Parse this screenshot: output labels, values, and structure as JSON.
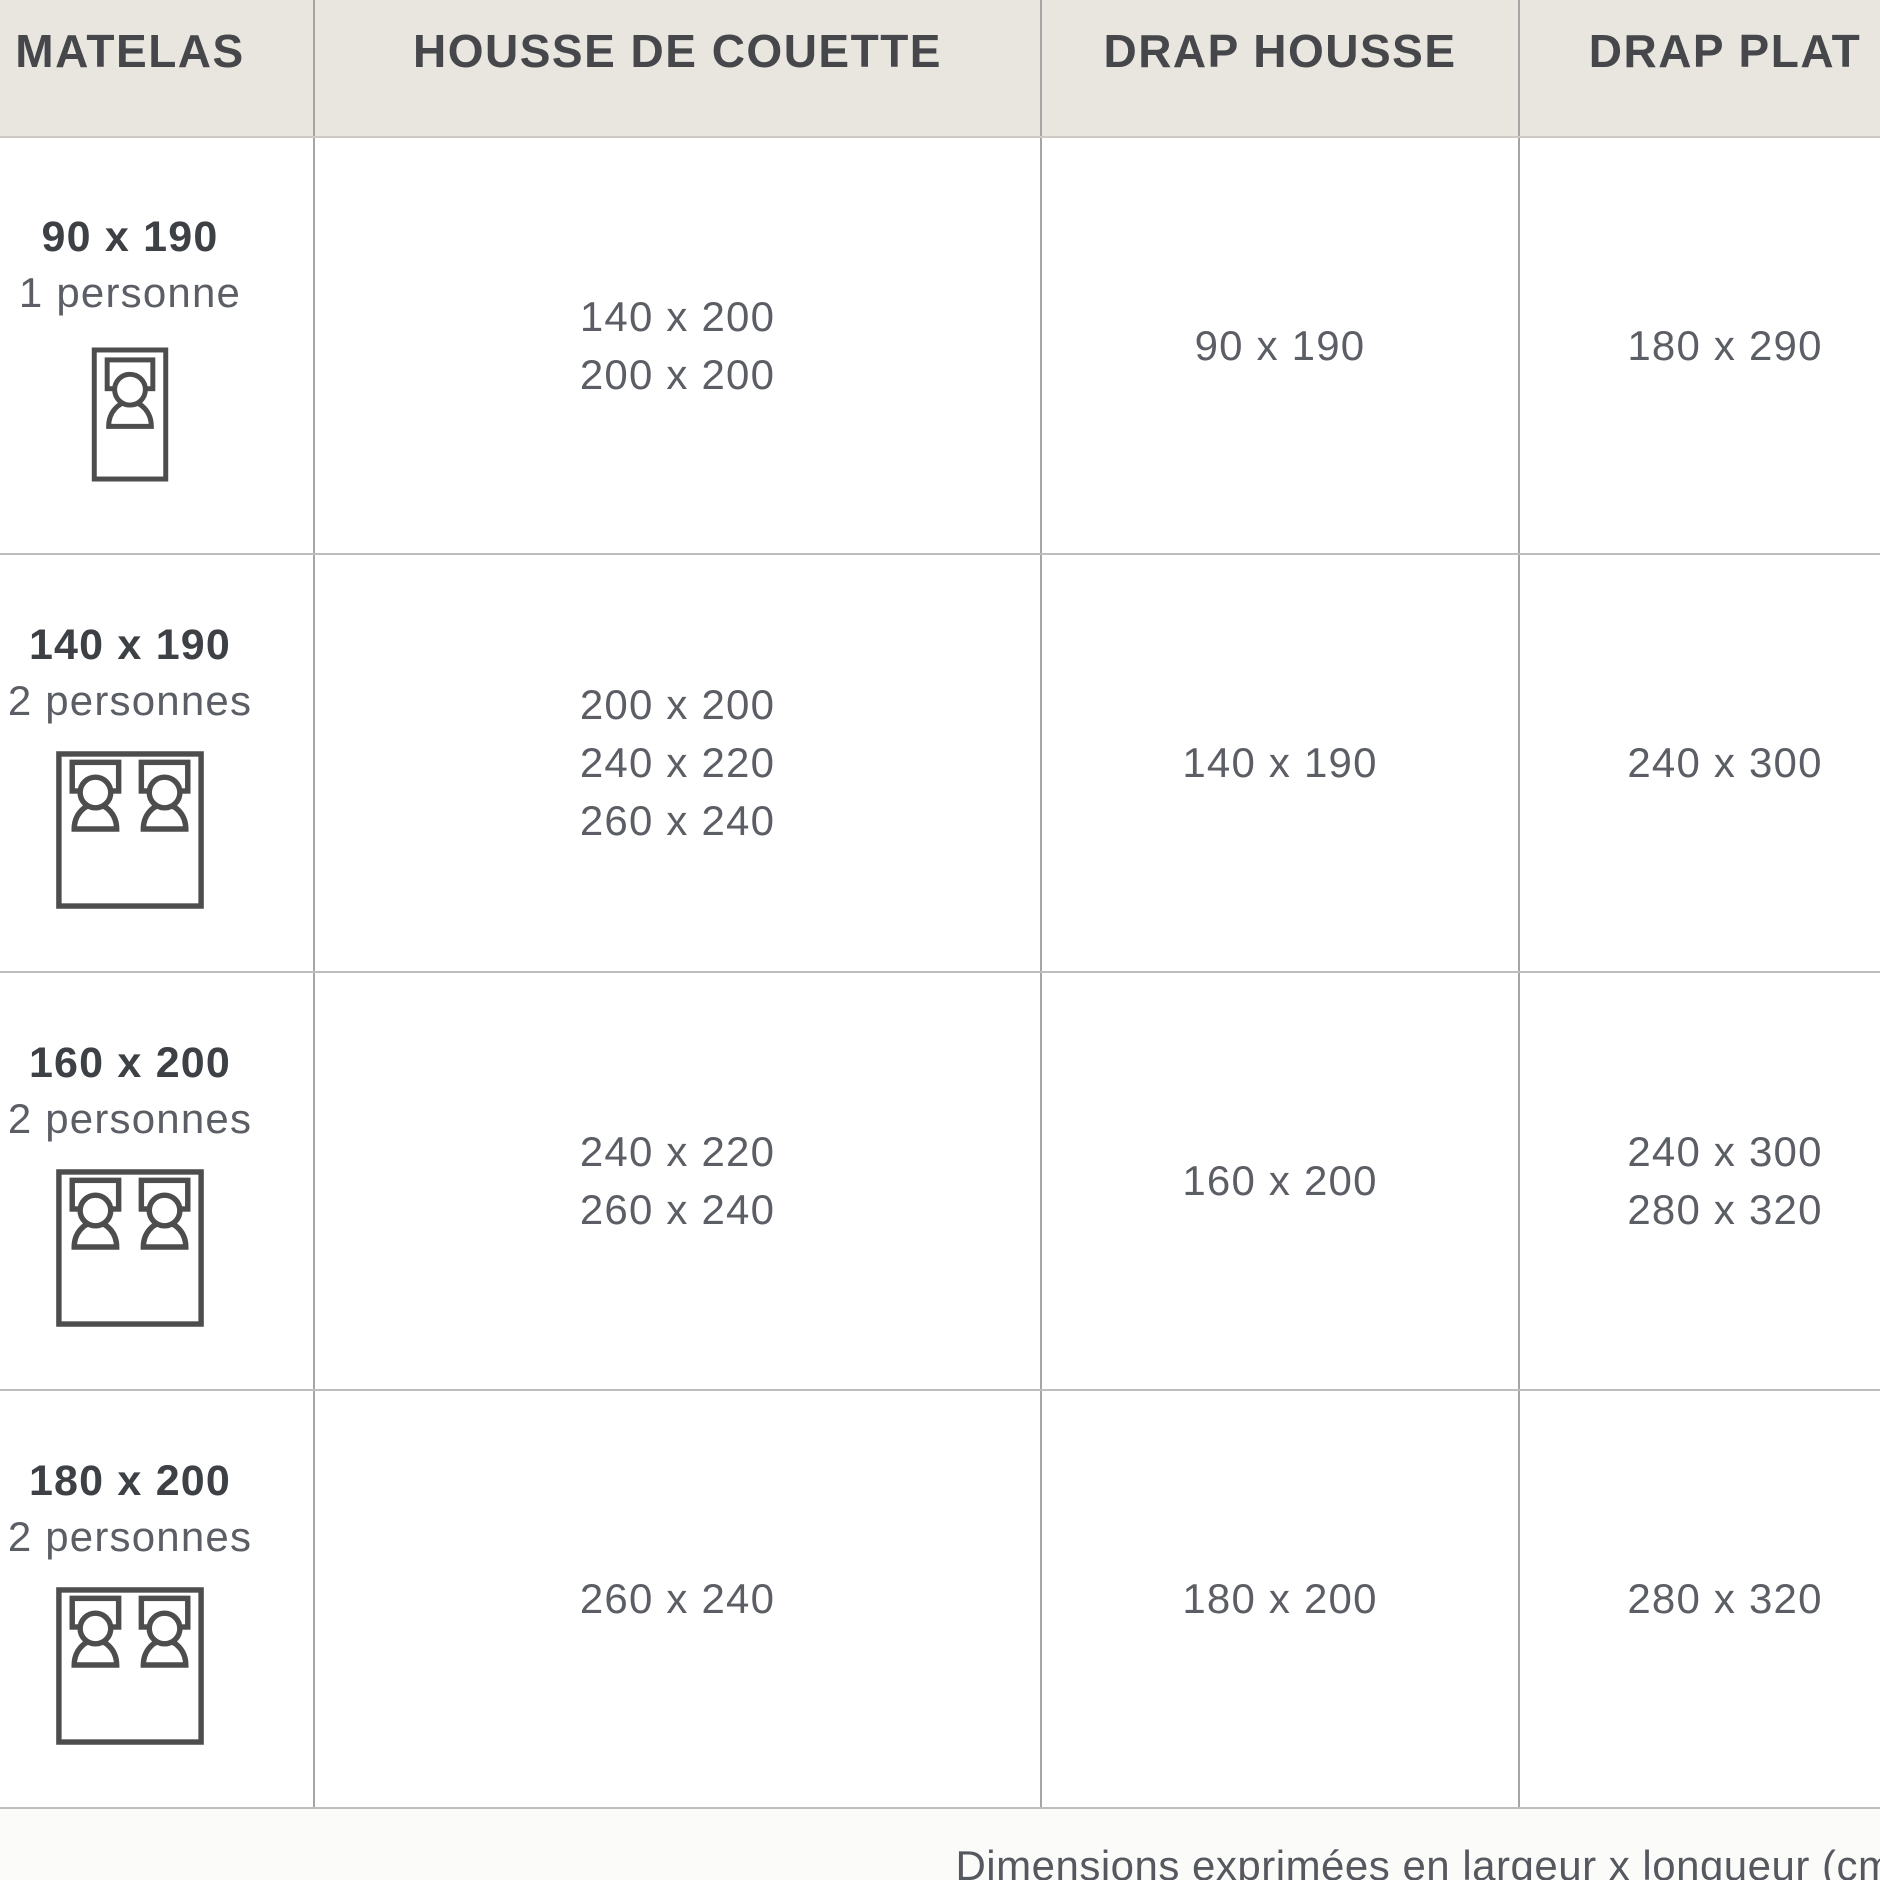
{
  "table": {
    "columns": [
      {
        "label": "MATELAS"
      },
      {
        "label": "HOUSSE DE COUETTE"
      },
      {
        "label": "DRAP HOUSSE"
      },
      {
        "label": "DRAP PLAT"
      }
    ],
    "rows": [
      {
        "matelas_size": "90 x 190",
        "persons": "1 personne",
        "bed_icon": "single-bed-icon",
        "housse_de_couette": [
          "140 x 200",
          "200 x 200"
        ],
        "drap_housse": [
          "90 x 190"
        ],
        "drap_plat": [
          "180 x 290"
        ]
      },
      {
        "matelas_size": "140 x 190",
        "persons": "2 personnes",
        "bed_icon": "double-bed-icon",
        "housse_de_couette": [
          "200 x 200",
          "240 x 220",
          "260 x 240"
        ],
        "drap_housse": [
          "140 x 190"
        ],
        "drap_plat": [
          "240 x 300"
        ]
      },
      {
        "matelas_size": "160 x 200",
        "persons": "2 personnes",
        "bed_icon": "double-bed-icon",
        "housse_de_couette": [
          "240 x 220",
          "260 x 240"
        ],
        "drap_housse": [
          "160 x 200"
        ],
        "drap_plat": [
          "240 x 300",
          "280 x 320"
        ]
      },
      {
        "matelas_size": "180 x 200",
        "persons": "2 personnes",
        "bed_icon": "double-bed-icon",
        "housse_de_couette": [
          "260 x 240"
        ],
        "drap_housse": [
          "180 x 200"
        ],
        "drap_plat": [
          "280 x 320"
        ]
      }
    ]
  },
  "footnote": "Dimensions exprimées en largeur x longueur (cm)",
  "colors": {
    "header_background": "#e9e5df",
    "header_text": "#45474b",
    "body_text": "#5b5e64",
    "bold_text": "#3d4045",
    "vertical_border": "#a5a5a5",
    "horizontal_border": "#bdbdbd",
    "icon_stroke": "#4d4d4d"
  }
}
